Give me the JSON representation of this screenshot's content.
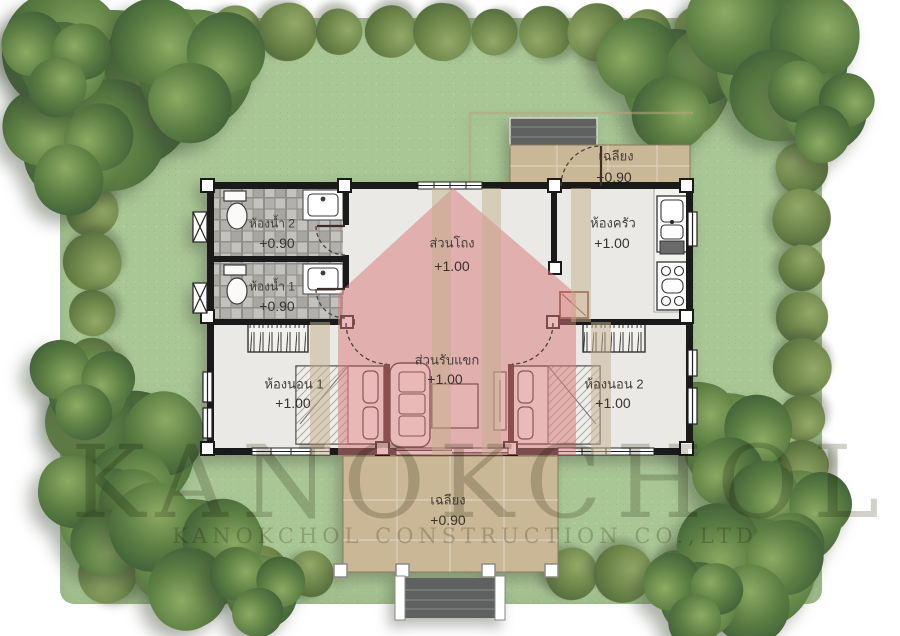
{
  "watermark": {
    "line1": "KANOKCHOL",
    "line2": "KANOKCHOL CONSTRUCTION CO.,LTD"
  },
  "rooms": {
    "bathroom2": {
      "name": "ห้องน้ำ 2",
      "elevation": "+0.90"
    },
    "bathroom1": {
      "name": "ห้องน้ำ 1",
      "elevation": "+0.90"
    },
    "hall": {
      "name": "ส่วนโถง",
      "elevation": "+1.00"
    },
    "kitchen": {
      "name": "ห้องครัว",
      "elevation": "+1.00"
    },
    "living": {
      "name": "ส่วนรับแขก",
      "elevation": "+1.00"
    },
    "bedroom1": {
      "name": "ห้องนอน 1",
      "elevation": "+1.00"
    },
    "bedroom2": {
      "name": "ห้องนอน 2",
      "elevation": "+1.00"
    },
    "porch_top": {
      "name": "เฉลียง",
      "elevation": "+0.90"
    },
    "porch_bottom": {
      "name": "เฉลียง",
      "elevation": "+0.90"
    }
  },
  "colors": {
    "lawn": "#a9c795",
    "overlay_pink": "#d97b7b",
    "porch_tan": "#c9b795",
    "wall_black": "#1a1a1a",
    "steps_gray": "#5f6160",
    "stripe_tan": "#c4b08c"
  }
}
